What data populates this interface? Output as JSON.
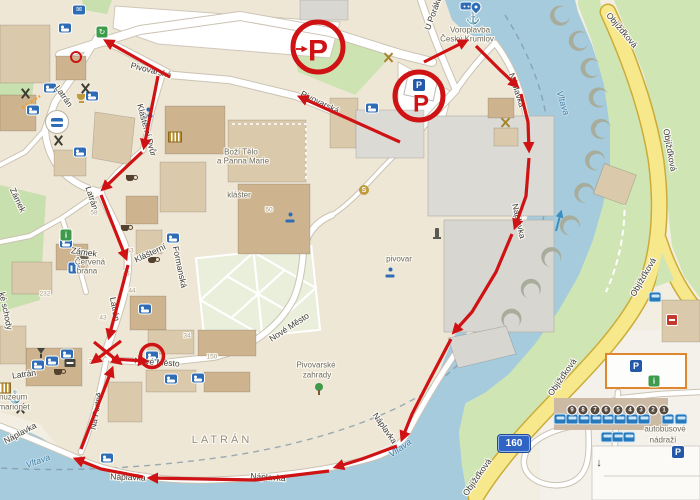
{
  "colors": {
    "route": "#cf1214",
    "river": "#a6cbdc",
    "park": "#cfe5b4",
    "road_major_fill": "#f7e88b",
    "water_label": "#3d7ea6"
  },
  "road_shield": {
    "text": "160"
  },
  "labels": {
    "streets": [
      {
        "text": "Pivovarská",
        "x": 151,
        "y": 70,
        "r": 14
      },
      {
        "text": "Pivovarská",
        "x": 320,
        "y": 102,
        "r": 26
      },
      {
        "text": "Latrán",
        "x": 64,
        "y": 96,
        "r": 55
      },
      {
        "text": "Latrán",
        "x": 92,
        "y": 198,
        "r": 72
      },
      {
        "text": "Latrán",
        "x": 115,
        "y": 309,
        "r": 80
      },
      {
        "text": "Latrán",
        "x": 24,
        "y": 374,
        "r": -8
      },
      {
        "text": "Zámek",
        "x": 18,
        "y": 200,
        "r": 65
      },
      {
        "text": "Zámek",
        "x": 84,
        "y": 252,
        "r": 8
      },
      {
        "text": "Klášterní Dvůr",
        "x": 147,
        "y": 130,
        "r": 75
      },
      {
        "text": "Klášterní",
        "x": 150,
        "y": 253,
        "r": -25
      },
      {
        "text": "Formanská",
        "x": 180,
        "y": 267,
        "r": 78
      },
      {
        "text": "Nové Město",
        "x": 157,
        "y": 362,
        "r": 4
      },
      {
        "text": "Nové Město",
        "x": 289,
        "y": 327,
        "r": -33
      },
      {
        "text": "Na Fortně",
        "x": 96,
        "y": 411,
        "r": -80
      },
      {
        "text": "Náplavka",
        "x": 517,
        "y": 90,
        "r": 72
      },
      {
        "text": "Náplavka",
        "x": 519,
        "y": 221,
        "r": 77
      },
      {
        "text": "Náplavka",
        "x": 385,
        "y": 428,
        "r": 55
      },
      {
        "text": "Náplavka",
        "x": 268,
        "y": 477,
        "r": 4
      },
      {
        "text": "Náplavka",
        "x": 128,
        "y": 477,
        "r": 2
      },
      {
        "text": "Náplavka",
        "x": 20,
        "y": 433,
        "r": -28
      },
      {
        "text": "Objížďková",
        "x": 622,
        "y": 30,
        "r": 50
      },
      {
        "text": "Objížďková",
        "x": 670,
        "y": 150,
        "r": 80
      },
      {
        "text": "Objížďková",
        "x": 643,
        "y": 277,
        "r": -60
      },
      {
        "text": "Objížďková",
        "x": 562,
        "y": 377,
        "r": -55
      },
      {
        "text": "Objížďková",
        "x": 477,
        "y": 477,
        "r": -55
      },
      {
        "text": "U Poráků",
        "x": 433,
        "y": 13,
        "r": -70
      },
      {
        "text": "ké schody",
        "x": 6,
        "y": 311,
        "r": 78
      }
    ],
    "rivers": [
      {
        "text": "Vltava",
        "x": 563,
        "y": 103,
        "r": 73
      },
      {
        "text": "Vltava",
        "x": 400,
        "y": 448,
        "r": -35
      },
      {
        "text": "Vltava",
        "x": 38,
        "y": 461,
        "r": -20
      }
    ],
    "pois": [
      {
        "text": "Voroplavba",
        "x": 470,
        "y": 30
      },
      {
        "text": "Český Krumlov",
        "x": 467,
        "y": 39
      },
      {
        "text": "pivovar",
        "x": 399,
        "y": 259
      },
      {
        "text": "klášter",
        "x": 239,
        "y": 195
      },
      {
        "text": "Boží Tělo",
        "x": 241,
        "y": 152
      },
      {
        "text": "a Panna Marie",
        "x": 243,
        "y": 161
      },
      {
        "text": "Pivovarské",
        "x": 316,
        "y": 365
      },
      {
        "text": "zahrady",
        "x": 317,
        "y": 375
      },
      {
        "text": "autobusové",
        "x": 665,
        "y": 429
      },
      {
        "text": "nádraží",
        "x": 663,
        "y": 440
      },
      {
        "text": "muzeum",
        "x": 12,
        "y": 397
      },
      {
        "text": "marionet",
        "x": 14,
        "y": 407
      },
      {
        "text": "Červená",
        "x": 90,
        "y": 262
      },
      {
        "text": "brána",
        "x": 87,
        "y": 271
      }
    ],
    "districts": [
      {
        "text": "LATRÁN",
        "x": 222,
        "y": 440
      }
    ],
    "house_numbers": [
      {
        "text": "232",
        "x": 45,
        "y": 294
      },
      {
        "text": "58",
        "x": 94,
        "y": 213
      },
      {
        "text": "53",
        "x": 130,
        "y": 251
      },
      {
        "text": "46",
        "x": 126,
        "y": 274
      },
      {
        "text": "44",
        "x": 132,
        "y": 291
      },
      {
        "text": "43",
        "x": 103,
        "y": 318
      },
      {
        "text": "50",
        "x": 269,
        "y": 210
      },
      {
        "text": "34",
        "x": 187,
        "y": 336
      },
      {
        "text": "27",
        "x": 92,
        "y": 362
      },
      {
        "text": "150",
        "x": 212,
        "y": 357
      }
    ]
  },
  "icons": [
    {
      "type": "bed",
      "x": 65,
      "y": 28
    },
    {
      "type": "bed",
      "x": 50,
      "y": 88
    },
    {
      "type": "bed",
      "x": 92,
      "y": 96
    },
    {
      "type": "bed",
      "x": 33,
      "y": 110
    },
    {
      "type": "bed",
      "x": 80,
      "y": 152
    },
    {
      "type": "bed",
      "x": 372,
      "y": 108
    },
    {
      "type": "bed",
      "x": 66,
      "y": 243
    },
    {
      "type": "bed",
      "x": 173,
      "y": 238
    },
    {
      "type": "bed",
      "x": 145,
      "y": 309
    },
    {
      "type": "bed",
      "x": 38,
      "y": 365
    },
    {
      "type": "bed",
      "x": 52,
      "y": 361
    },
    {
      "type": "bed",
      "x": 67,
      "y": 354
    },
    {
      "type": "bed",
      "x": 171,
      "y": 379
    },
    {
      "type": "bed",
      "x": 198,
      "y": 378
    },
    {
      "type": "bed",
      "x": 107,
      "y": 458
    },
    {
      "type": "bed",
      "x": 152,
      "y": 356
    },
    {
      "type": "bed-circled",
      "x": 57,
      "y": 122
    },
    {
      "type": "info",
      "x": 66,
      "y": 235
    },
    {
      "type": "info",
      "x": 654,
      "y": 381
    },
    {
      "type": "envelope",
      "x": 79,
      "y": 10
    },
    {
      "type": "recycle",
      "x": 102,
      "y": 32
    },
    {
      "type": "restaurant",
      "x": 25,
      "y": 93
    },
    {
      "type": "restaurant",
      "x": 85,
      "y": 88
    },
    {
      "type": "restaurant",
      "x": 58,
      "y": 140
    },
    {
      "type": "restaurant",
      "x": 20,
      "y": 408
    },
    {
      "type": "tools",
      "x": 388,
      "y": 57
    },
    {
      "type": "tools",
      "x": 505,
      "y": 122
    },
    {
      "type": "coffee",
      "x": 130,
      "y": 178
    },
    {
      "type": "coffee",
      "x": 125,
      "y": 228
    },
    {
      "type": "coffee",
      "x": 152,
      "y": 260
    },
    {
      "type": "coffee",
      "x": 58,
      "y": 372
    },
    {
      "type": "trophy",
      "x": 81,
      "y": 97
    },
    {
      "type": "anchor",
      "x": 15,
      "y": 397
    },
    {
      "type": "anchor",
      "x": 473,
      "y": 18
    },
    {
      "type": "museum",
      "x": 4,
      "y": 388
    },
    {
      "type": "museum",
      "x": 175,
      "y": 137
    },
    {
      "type": "fountain",
      "x": 148,
      "y": 113
    },
    {
      "type": "fountain",
      "x": 290,
      "y": 218
    },
    {
      "type": "fountain",
      "x": 390,
      "y": 273
    },
    {
      "type": "monument",
      "x": 437,
      "y": 233
    },
    {
      "type": "money",
      "x": 364,
      "y": 190
    },
    {
      "type": "gate",
      "x": 83,
      "y": 257
    },
    {
      "type": "wc",
      "x": 74,
      "y": 268
    },
    {
      "type": "atm",
      "x": 70,
      "y": 363
    },
    {
      "type": "glass",
      "x": 41,
      "y": 353
    },
    {
      "type": "tree",
      "x": 319,
      "y": 389
    },
    {
      "type": "binoculars",
      "x": 466,
      "y": 6
    },
    {
      "type": "pin",
      "x": 476,
      "y": 7
    },
    {
      "type": "parking",
      "x": 419,
      "y": 85
    },
    {
      "type": "parking",
      "x": 636,
      "y": 366
    },
    {
      "type": "parking",
      "x": 678,
      "y": 452
    },
    {
      "type": "bank",
      "x": 672,
      "y": 320
    },
    {
      "type": "bus",
      "x": 655,
      "y": 297
    },
    {
      "type": "bus",
      "x": 560,
      "y": 419
    },
    {
      "type": "bus",
      "x": 572,
      "y": 419
    },
    {
      "type": "bus",
      "x": 584,
      "y": 419
    },
    {
      "type": "bus",
      "x": 596,
      "y": 419
    },
    {
      "type": "bus",
      "x": 608,
      "y": 419
    },
    {
      "type": "bus",
      "x": 620,
      "y": 419
    },
    {
      "type": "bus",
      "x": 632,
      "y": 419
    },
    {
      "type": "bus",
      "x": 644,
      "y": 419
    },
    {
      "type": "bus",
      "x": 668,
      "y": 419
    },
    {
      "type": "bus",
      "x": 681,
      "y": 419
    },
    {
      "type": "bus",
      "x": 607,
      "y": 437
    },
    {
      "type": "bus",
      "x": 618,
      "y": 437
    },
    {
      "type": "bus",
      "x": 629,
      "y": 437
    },
    {
      "type": "platform",
      "x": 572,
      "y": 410,
      "text": "9"
    },
    {
      "type": "platform",
      "x": 583,
      "y": 410,
      "text": "8"
    },
    {
      "type": "platform",
      "x": 595,
      "y": 410,
      "text": "7"
    },
    {
      "type": "platform",
      "x": 606,
      "y": 410,
      "text": "6"
    },
    {
      "type": "platform",
      "x": 618,
      "y": 410,
      "text": "5"
    },
    {
      "type": "platform",
      "x": 630,
      "y": 410,
      "text": "4"
    },
    {
      "type": "platform",
      "x": 641,
      "y": 410,
      "text": "3"
    },
    {
      "type": "platform",
      "x": 653,
      "y": 410,
      "text": "2"
    },
    {
      "type": "platform",
      "x": 664,
      "y": 410,
      "text": "1"
    },
    {
      "type": "arrow-down",
      "x": 599,
      "y": 463
    }
  ],
  "icon_glyphs": {
    "envelope": "✉",
    "anchor": "⚓",
    "recycle": "↻",
    "arrow-down": "↓",
    "info": "i",
    "parking": "P",
    "money": "S"
  },
  "route": {
    "color": "#cf1214",
    "segments": [
      {
        "pts": [
          [
            170,
            77
          ],
          [
            106,
            41
          ]
        ]
      },
      {
        "pts": [
          [
            400,
            142
          ],
          [
            300,
            97
          ]
        ]
      },
      {
        "pts": [
          [
            424,
            62
          ],
          [
            466,
            41
          ]
        ]
      },
      {
        "pts": [
          [
            158,
            76
          ],
          [
            144,
            147
          ]
        ]
      },
      {
        "pts": [
          [
            142,
            152
          ],
          [
            103,
            189
          ]
        ]
      },
      {
        "pts": [
          [
            101,
            195
          ],
          [
            126,
            258
          ]
        ]
      },
      {
        "pts": [
          [
            128,
            265
          ],
          [
            109,
            337
          ]
        ]
      },
      {
        "pts": [
          [
            121,
            341
          ],
          [
            93,
            362
          ]
        ]
      },
      {
        "pts": [
          [
            94,
            342
          ],
          [
            120,
            363
          ]
        ]
      },
      {
        "pts": [
          [
            112,
            359
          ],
          [
            146,
            361
          ]
        ]
      },
      {
        "pts": [
          [
            81,
            449
          ],
          [
            112,
            369
          ]
        ]
      },
      {
        "pts": [
          [
            476,
            46
          ],
          [
            500,
            70
          ],
          [
            517,
            86
          ]
        ]
      },
      {
        "pts": [
          [
            521,
            94
          ],
          [
            528,
            122
          ],
          [
            529,
            150
          ]
        ]
      },
      {
        "pts": [
          [
            529,
            158
          ],
          [
            526,
            196
          ],
          [
            515,
            227
          ]
        ]
      },
      {
        "pts": [
          [
            512,
            234
          ],
          [
            496,
            272
          ],
          [
            472,
            312
          ],
          [
            454,
            332
          ]
        ]
      },
      {
        "pts": [
          [
            451,
            339
          ],
          [
            430,
            379
          ],
          [
            412,
            414
          ],
          [
            402,
            439
          ]
        ]
      },
      {
        "pts": [
          [
            397,
            446
          ],
          [
            362,
            459
          ],
          [
            336,
            467
          ]
        ]
      },
      {
        "pts": [
          [
            329,
            471
          ],
          [
            255,
            480
          ],
          [
            150,
            478
          ]
        ]
      },
      {
        "pts": [
          [
            143,
            477
          ],
          [
            101,
            469
          ],
          [
            76,
            459
          ]
        ]
      },
      {
        "pts": [
          [
            296,
            49
          ],
          [
            306,
            49
          ]
        ],
        "w": 1.8
      }
    ],
    "circles": [
      {
        "x": 318,
        "y": 47,
        "r": 25,
        "w": 5
      },
      {
        "x": 419,
        "y": 96,
        "r": 24,
        "w": 5
      },
      {
        "x": 152,
        "y": 356,
        "r": 11.5,
        "w": 3.5
      },
      {
        "x": 76,
        "y": 57,
        "r": 5,
        "w": 2
      }
    ],
    "p_marks": [
      {
        "text": "P",
        "x": 318,
        "y": 51,
        "size": 30
      },
      {
        "text": "P",
        "x": 421,
        "y": 104,
        "size": 24
      }
    ]
  }
}
